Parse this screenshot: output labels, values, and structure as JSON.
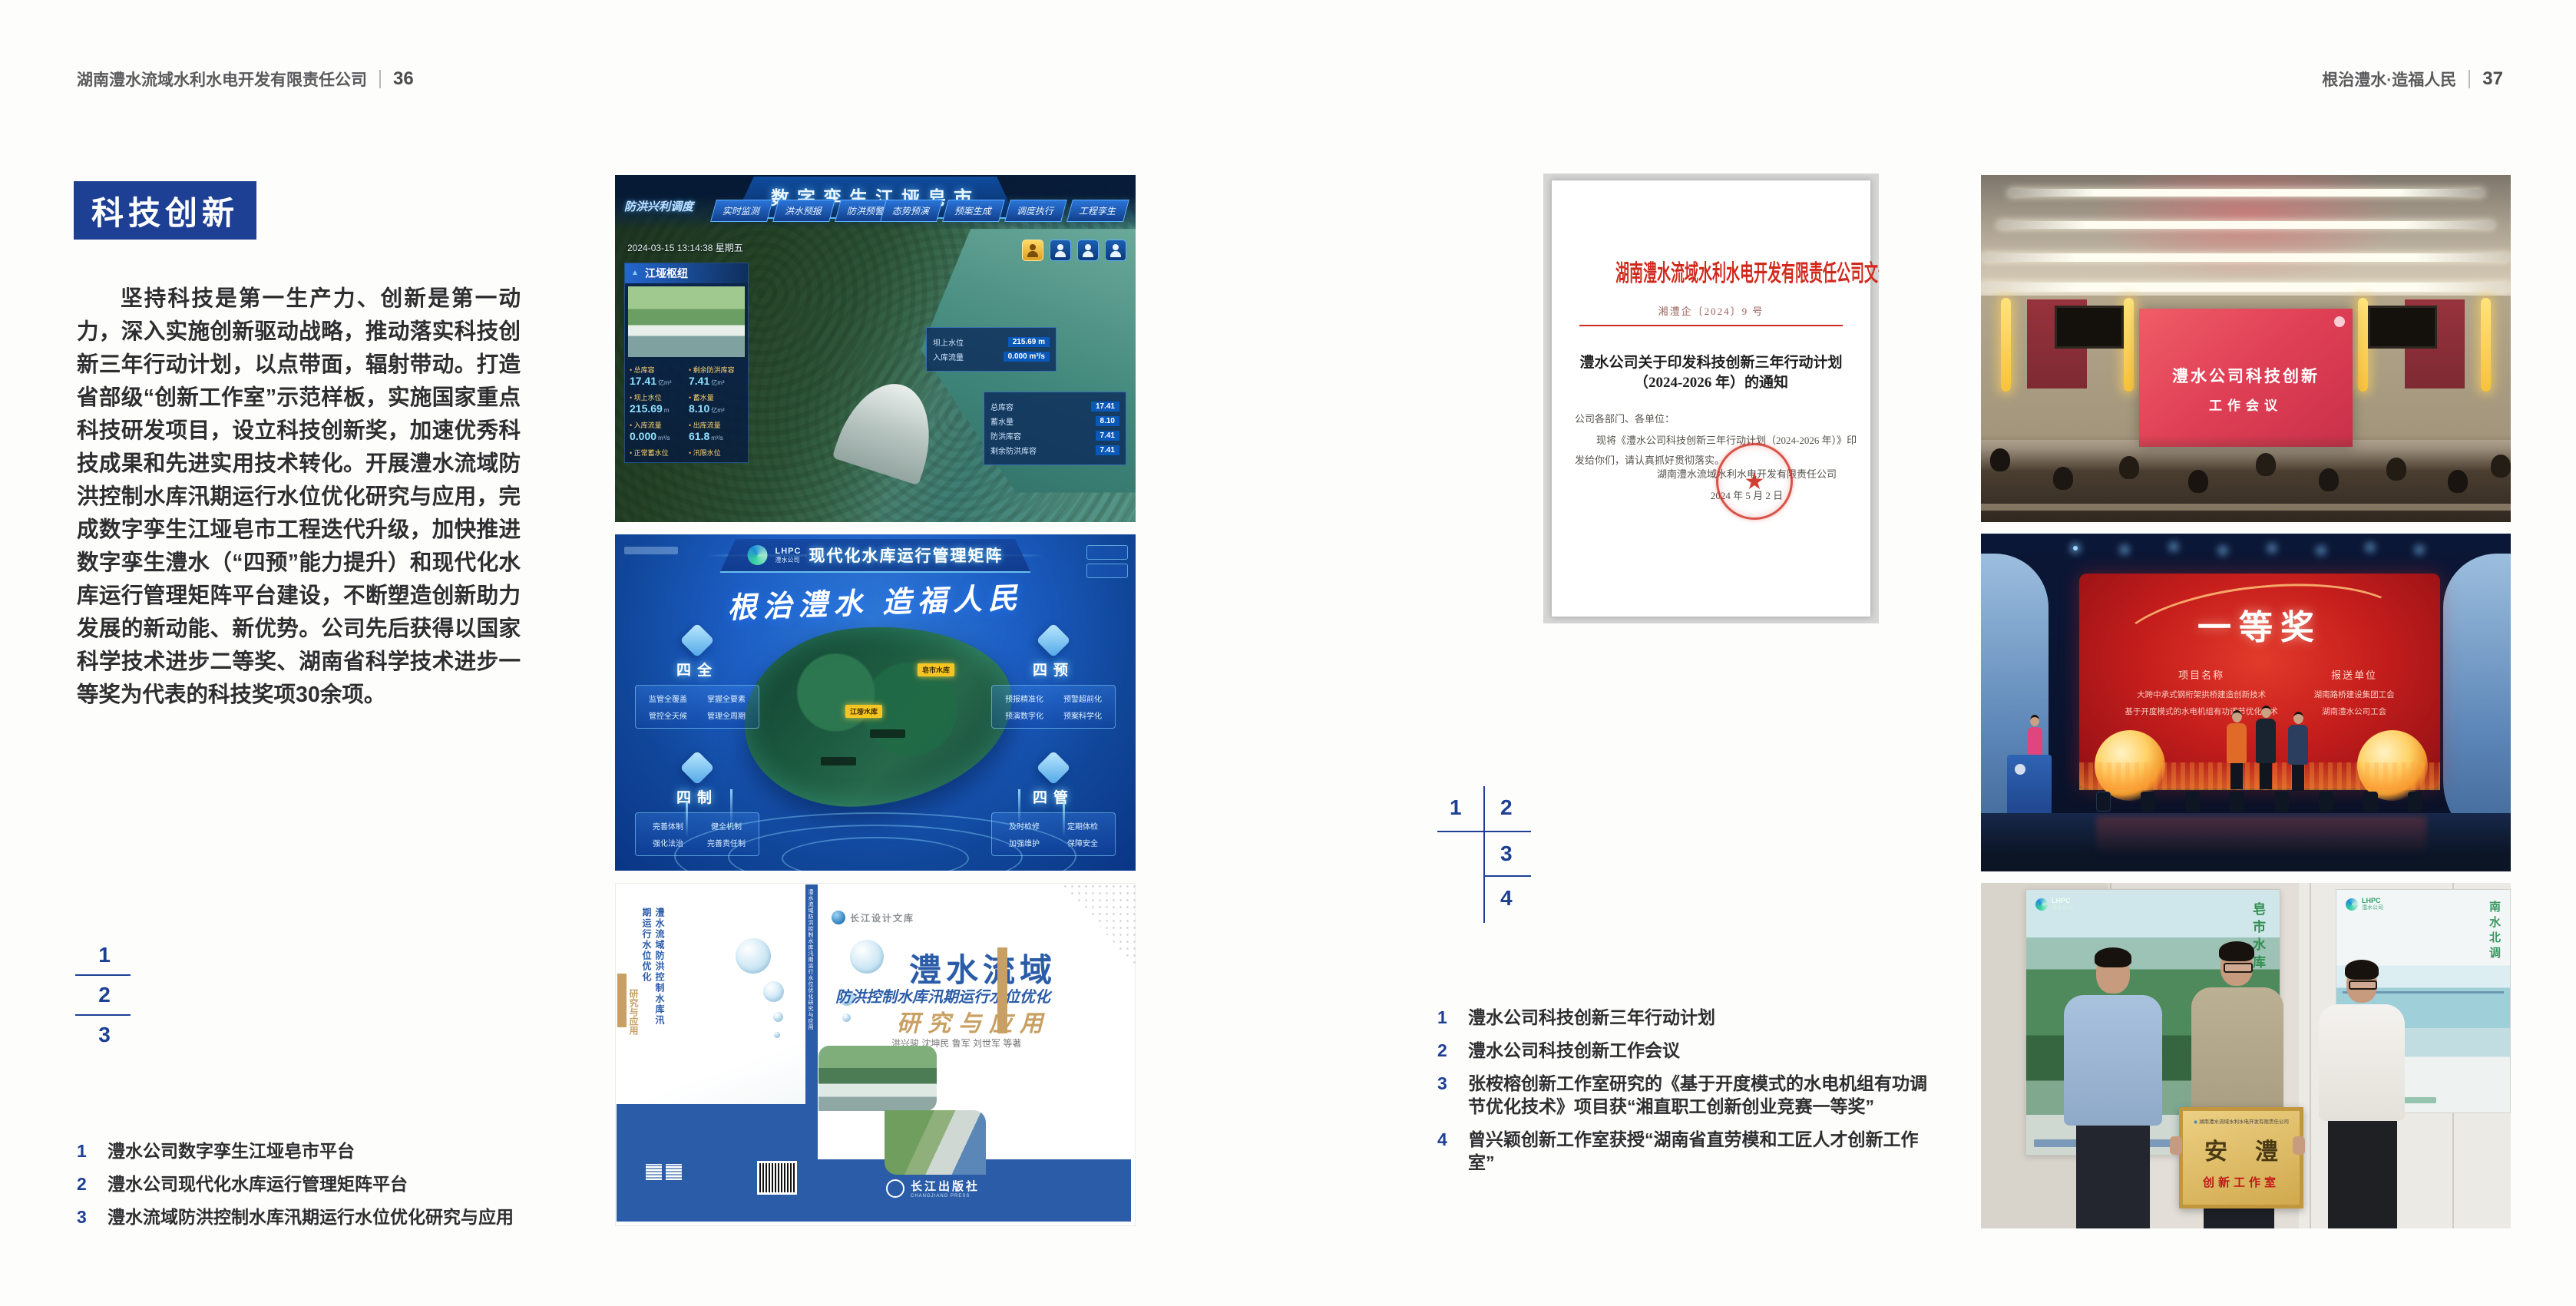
{
  "doc": {
    "left_header": {
      "company": "湖南澧水流域水利水电开发有限责任公司",
      "page": "36"
    },
    "right_header": {
      "slogan": "根治澧水·造福人民",
      "page": "37"
    },
    "section_title": "科技创新",
    "body_text": "坚持科技是第一生产力、创新是第一动力，深入实施创新驱动战略，推动落实科技创新三年行动计划，以点带面，辐射带动。打造省部级“创新工作室”示范样板，实施国家重点科技研发项目，设立科技创新奖，加速优秀科技成果和先进实用技术转化。开展澧水流域防洪控制水库汛期运行水位优化研究与应用，完成数字孪生江垭皂市工程迭代升级，加快推进数字孪生澧水（“四预”能力提升）和现代化水库运行管理矩阵平台建设，不断塑造创新助力发展的新动能、新优势。公司先后获得以国家科学技术进步二等奖、湖南省科学技术进步一等奖为代表的科技奖项30余项。",
    "left_fig_nums": [
      "1",
      "2",
      "3"
    ],
    "right_fig_nums": [
      "1",
      "2",
      "3",
      "4"
    ],
    "left_captions": [
      {
        "num": "1",
        "text": "澧水公司数字孪生江垭皂市平台"
      },
      {
        "num": "2",
        "text": "澧水公司现代化水库运行管理矩阵平台"
      },
      {
        "num": "3",
        "text": "澧水流域防洪控制水库汛期运行水位优化研究与应用"
      }
    ],
    "right_captions": [
      {
        "num": "1",
        "text": "澧水公司科技创新三年行动计划"
      },
      {
        "num": "2",
        "text": "澧水公司科技创新工作会议"
      },
      {
        "num": "3",
        "text": "张桉榕创新工作室研究的《基于开度模式的水电机组有功调节优化技术》项目获“湘直职工创新创业竞赛一等奖”"
      },
      {
        "num": "4",
        "text": "曾兴颖创新工作室获授“湖南省直劳模和工匠人才创新工作室”"
      }
    ]
  },
  "fig_dashboard": {
    "title": "数字孪生江垭皂市",
    "system_label": "防洪兴利调度",
    "tabs_left": [
      "实时监测",
      "洪水预报",
      "防洪预警"
    ],
    "tabs_right": [
      "态势预演",
      "预案生成",
      "调度执行",
      "工程孪生"
    ],
    "datetime": "2024-03-15 13:14:38 星期五",
    "panel_title": "江垭枢纽",
    "stats": [
      {
        "label": "总库容",
        "value": "17.41",
        "unit": "亿m³"
      },
      {
        "label": "剩余防洪库容",
        "value": "7.41",
        "unit": "亿m³"
      },
      {
        "label": "坝上水位",
        "value": "215.69",
        "unit": "m"
      },
      {
        "label": "蓄水量",
        "value": "8.10",
        "unit": "亿m³"
      },
      {
        "label": "入库流量",
        "value": "0.000",
        "unit": "m³/s"
      },
      {
        "label": "出库流量",
        "value": "61.8",
        "unit": "m³/s"
      },
      {
        "label": "正常蓄水位",
        "value": "",
        "unit": ""
      },
      {
        "label": "汛限水位",
        "value": "",
        "unit": ""
      }
    ],
    "float1": {
      "l1": "坝上水位",
      "v1": "215.69 m",
      "l2": "入库流量",
      "v2": "0.000 m³/s"
    },
    "float2": [
      {
        "label": "总库容",
        "value": "17.41"
      },
      {
        "label": "蓄水量",
        "value": "8.10"
      },
      {
        "label": "防洪库容",
        "value": "7.41"
      },
      {
        "label": "剩余防洪库容",
        "value": "7.41"
      }
    ]
  },
  "fig_matrix": {
    "logo": "LHPC",
    "logo_sub": "澧水公司",
    "title": "现代化水库运行管理矩阵",
    "slogan": "根治澧水 造福人民",
    "marker1": "江垭水库",
    "marker2": "皂市水库",
    "panels": [
      {
        "title": "四全",
        "items": [
          "监管全覆盖",
          "掌握全要素",
          "管控全天候",
          "管理全周期"
        ]
      },
      {
        "title": "四预",
        "items": [
          "预报精准化",
          "预警超前化",
          "预演数字化",
          "预案科学化"
        ]
      },
      {
        "title": "四制",
        "items": [
          "完善体制",
          "健全机制",
          "强化法治",
          "完善责任制"
        ]
      },
      {
        "title": "四管",
        "items": [
          "及时检修",
          "定期体检",
          "加强维护",
          "保障安全"
        ]
      }
    ]
  },
  "fig_book": {
    "series": "长江设计文库",
    "title_main": "澧水流域",
    "title_sub": "防洪控制水库汛期运行水位优化",
    "title_tail": "研究与应用",
    "authors": "洪兴骏 沈坤民 鲁军 刘世军 等著",
    "publisher": "长江出版社",
    "publisher_en": "CHANGJIANG PRESS",
    "spine_text": "澧水流域防洪控制水库汛期运行水位优化研究与应用",
    "back_vertical": "澧水流域防洪控制水库汛期运行水位优化",
    "back_vertical2": "研究与应用"
  },
  "fig_document": {
    "header": "湖南澧水流域水利水电开发有限责任公司文件",
    "doc_no": "湘澧企〔2024〕9 号",
    "title_l1": "澧水公司关于印发科技创新三年行动计划",
    "title_l2": "（2024-2026 年）的通知",
    "salutation": "公司各部门、各单位：",
    "body_l1": "现将《澧水公司科技创新三年行动计划（2024-2026 年）》印",
    "body_l2": "发给你们，请认真抓好贯彻落实。",
    "signer": "湖南澧水流域水利水电开发有限责任公司",
    "date": "2024 年 5 月 2 日",
    "seal_star": "★"
  },
  "fig_meeting": {
    "screen_l1": "澧水公司科技创新",
    "screen_l2": "工作会议"
  },
  "fig_award": {
    "title": "一等奖",
    "col1": "项目名称",
    "col2": "报送单位",
    "p1": "大跨中承式钢桁架拱桥建造创新技术",
    "p2": "基于开度模式的水电机组有功调节优化技术",
    "u1": "湖南路桥建设集团工会",
    "u2": "湖南澧水公司工会"
  },
  "fig_plaque": {
    "poster_logo": "LHPC",
    "poster_logo_sub": "澧水公司",
    "poster1_vertical": "皂市水库",
    "poster2_vertical": "南水北调",
    "plaque_header": "湖南澧水流域水利水电开发有限责任公司",
    "plaque_word1": "安",
    "plaque_word2": "澧",
    "plaque_sub": "创新工作室"
  },
  "colors": {
    "accent_blue": "#1d3f94",
    "book_blue": "#2b5ca8",
    "doc_red": "#d0291c",
    "meeting_red": "#e04056",
    "award_red": "#c61e1c",
    "gold": "#c9a063"
  }
}
